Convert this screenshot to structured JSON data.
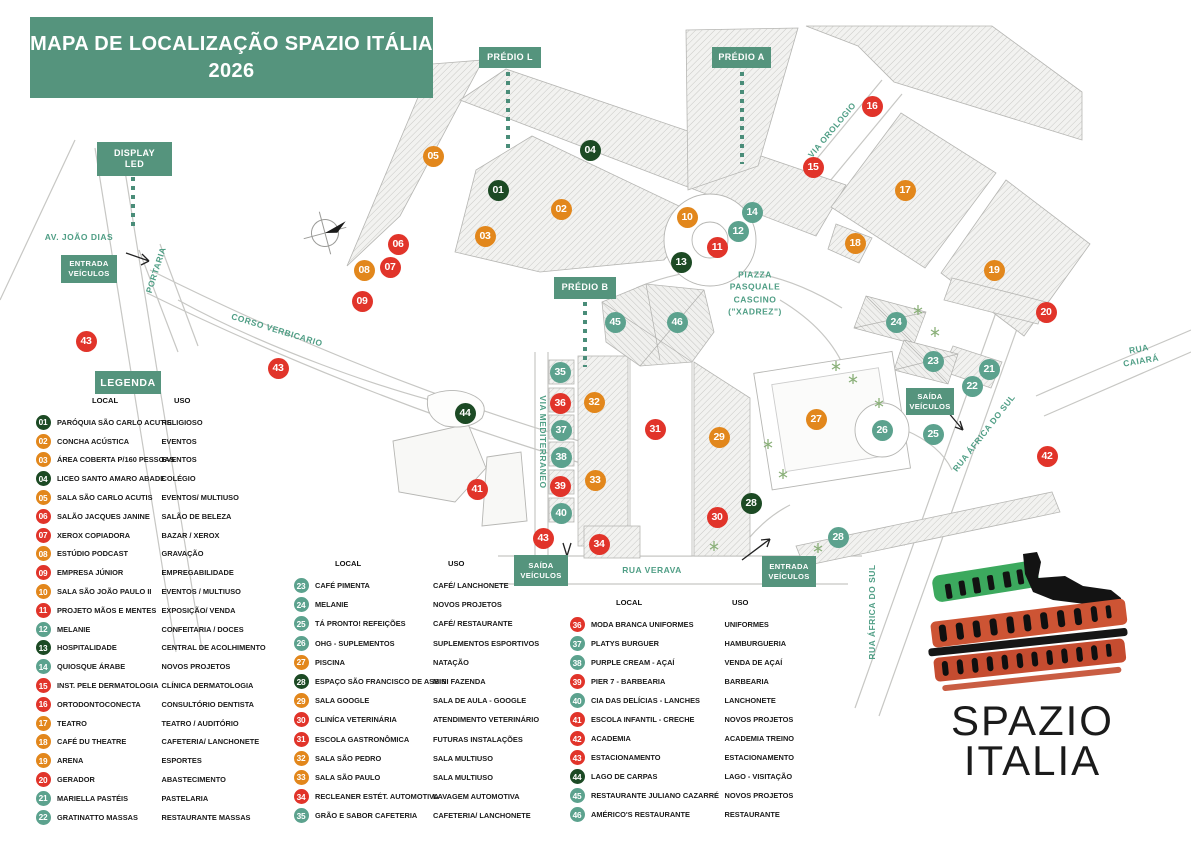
{
  "title": {
    "line1": "MAPA DE LOCALIZAÇÃO SPAZIO ITÁLIA",
    "line2": "2026"
  },
  "colors": {
    "green": "#1C4A24",
    "orange": "#E2871C",
    "red": "#E1342A",
    "teal": "#5CA28E",
    "box_teal": "#55947D",
    "street_text": "#4F9E85"
  },
  "map_labels": [
    {
      "id": "predio-l",
      "t": "PRÉDIO L",
      "x": 479,
      "y": 47,
      "w": 62,
      "h": 21
    },
    {
      "id": "predio-a",
      "t": "PRÉDIO A",
      "x": 712,
      "y": 47,
      "w": 59,
      "h": 21
    },
    {
      "id": "predio-b",
      "t": "PRÉDIO B",
      "x": 554,
      "y": 277,
      "w": 62,
      "h": 22
    },
    {
      "id": "display-led",
      "t": "DISPLAY\nLED",
      "x": 97,
      "y": 142,
      "w": 75,
      "h": 34
    }
  ],
  "gates": [
    {
      "id": "entrada-veiculos-oeste",
      "t": "ENTRADA\nVEÍCULOS",
      "x": 61,
      "y": 255,
      "w": 56,
      "h": 28
    },
    {
      "id": "saida-veiculos-leste",
      "t": "SAÍDA\nVEÍCULOS",
      "x": 906,
      "y": 388,
      "w": 48,
      "h": 27
    },
    {
      "id": "saida-veiculos-sul",
      "t": "SAÍDA\nVEÍCULOS",
      "x": 514,
      "y": 555,
      "w": 54,
      "h": 31
    },
    {
      "id": "entrada-veiculos-sul",
      "t": "ENTRADA\nVEÍCULOS",
      "x": 762,
      "y": 556,
      "w": 54,
      "h": 31
    }
  ],
  "streets": [
    {
      "t": "AV. JOÃO DIAS",
      "x": 79,
      "y": 237,
      "r": 0
    },
    {
      "t": "PORTARIA",
      "x": 156,
      "y": 270,
      "r": -72
    },
    {
      "t": "CORSO VERBICARIO",
      "x": 277,
      "y": 330,
      "r": 17
    },
    {
      "t": "VIA OROLOGIO",
      "x": 832,
      "y": 130,
      "r": -50
    },
    {
      "t": "VIA MEDITERRANEO",
      "x": 543,
      "y": 442,
      "r": 90
    },
    {
      "t": "RUA VERAVA",
      "x": 652,
      "y": 570,
      "r": 0
    },
    {
      "t": "RUA CAIARÁ",
      "x": 1140,
      "y": 355,
      "r": -10
    },
    {
      "t": "RUA ÁFRICA DO SUL",
      "x": 984,
      "y": 433,
      "r": -52
    },
    {
      "t": "RUA ÁFRICA DO SUL",
      "x": 872,
      "y": 612,
      "r": -90
    },
    {
      "t": "PIAZZA\nPASQUALE\nCASCINO\n(\"XADREZ\")",
      "x": 755,
      "y": 293,
      "r": 0
    }
  ],
  "markers": [
    {
      "n": "01",
      "c": "green",
      "x": 498,
      "y": 190
    },
    {
      "n": "02",
      "c": "orange",
      "x": 561,
      "y": 209
    },
    {
      "n": "03",
      "c": "orange",
      "x": 485,
      "y": 236
    },
    {
      "n": "04",
      "c": "green",
      "x": 590,
      "y": 150
    },
    {
      "n": "05",
      "c": "orange",
      "x": 433,
      "y": 156
    },
    {
      "n": "06",
      "c": "red",
      "x": 398,
      "y": 244
    },
    {
      "n": "07",
      "c": "red",
      "x": 390,
      "y": 267
    },
    {
      "n": "08",
      "c": "orange",
      "x": 364,
      "y": 270
    },
    {
      "n": "09",
      "c": "red",
      "x": 362,
      "y": 301
    },
    {
      "n": "10",
      "c": "orange",
      "x": 687,
      "y": 217
    },
    {
      "n": "11",
      "c": "red",
      "x": 717,
      "y": 247
    },
    {
      "n": "12",
      "c": "teal",
      "x": 738,
      "y": 231
    },
    {
      "n": "13",
      "c": "green",
      "x": 681,
      "y": 262
    },
    {
      "n": "14",
      "c": "teal",
      "x": 752,
      "y": 212
    },
    {
      "n": "15",
      "c": "red",
      "x": 813,
      "y": 167
    },
    {
      "n": "16",
      "c": "red",
      "x": 872,
      "y": 106
    },
    {
      "n": "17",
      "c": "orange",
      "x": 905,
      "y": 190
    },
    {
      "n": "18",
      "c": "orange",
      "x": 855,
      "y": 243
    },
    {
      "n": "19",
      "c": "orange",
      "x": 994,
      "y": 270
    },
    {
      "n": "20",
      "c": "red",
      "x": 1046,
      "y": 312
    },
    {
      "n": "21",
      "c": "teal",
      "x": 989,
      "y": 369
    },
    {
      "n": "22",
      "c": "teal",
      "x": 972,
      "y": 386
    },
    {
      "n": "23",
      "c": "teal",
      "x": 933,
      "y": 361
    },
    {
      "n": "24",
      "c": "teal",
      "x": 896,
      "y": 322
    },
    {
      "n": "25",
      "c": "teal",
      "x": 933,
      "y": 434
    },
    {
      "n": "26",
      "c": "teal",
      "x": 882,
      "y": 430
    },
    {
      "n": "27",
      "c": "orange",
      "x": 816,
      "y": 419
    },
    {
      "n": "28",
      "c": "green",
      "x": 751,
      "y": 503
    },
    {
      "n": "28",
      "c": "teal",
      "x": 838,
      "y": 537
    },
    {
      "n": "29",
      "c": "orange",
      "x": 719,
      "y": 437
    },
    {
      "n": "30",
      "c": "red",
      "x": 717,
      "y": 517
    },
    {
      "n": "31",
      "c": "red",
      "x": 655,
      "y": 429
    },
    {
      "n": "32",
      "c": "orange",
      "x": 594,
      "y": 402
    },
    {
      "n": "33",
      "c": "orange",
      "x": 595,
      "y": 480
    },
    {
      "n": "34",
      "c": "red",
      "x": 599,
      "y": 544
    },
    {
      "n": "35",
      "c": "teal",
      "x": 560,
      "y": 372
    },
    {
      "n": "36",
      "c": "red",
      "x": 560,
      "y": 403
    },
    {
      "n": "37",
      "c": "teal",
      "x": 561,
      "y": 430
    },
    {
      "n": "38",
      "c": "teal",
      "x": 561,
      "y": 457
    },
    {
      "n": "39",
      "c": "red",
      "x": 560,
      "y": 486
    },
    {
      "n": "40",
      "c": "teal",
      "x": 561,
      "y": 513
    },
    {
      "n": "41",
      "c": "red",
      "x": 477,
      "y": 489
    },
    {
      "n": "42",
      "c": "red",
      "x": 1047,
      "y": 456
    },
    {
      "n": "43",
      "c": "red",
      "x": 86,
      "y": 341
    },
    {
      "n": "43",
      "c": "red",
      "x": 278,
      "y": 368
    },
    {
      "n": "43",
      "c": "red",
      "x": 543,
      "y": 538
    },
    {
      "n": "44",
      "c": "green",
      "x": 465,
      "y": 413
    },
    {
      "n": "45",
      "c": "teal",
      "x": 615,
      "y": 322
    },
    {
      "n": "46",
      "c": "teal",
      "x": 677,
      "y": 322
    }
  ],
  "legend": {
    "header": "LEGENDA",
    "col_local": "LOCAL",
    "col_uso": "USO",
    "columns": [
      {
        "x": 33,
        "y": 392,
        "row_h": 18.8,
        "lw": 104.5,
        "hx": 59,
        "ux": 141,
        "items": [
          {
            "n": "01",
            "c": "green",
            "local": "PARÓQUIA SÃO CARLO ACUTIS",
            "uso": "RELIGIOSO"
          },
          {
            "n": "02",
            "c": "orange",
            "local": "CONCHA ACÚSTICA",
            "uso": "EVENTOS"
          },
          {
            "n": "03",
            "c": "orange",
            "local": "ÁREA COBERTA P/160 PESSOAS",
            "uso": "EVENTOS"
          },
          {
            "n": "04",
            "c": "green",
            "local": "LICEO SANTO AMARO ABADE",
            "uso": "COLÉGIO"
          },
          {
            "n": "05",
            "c": "orange",
            "local": "SALA SÃO CARLO ACUTIS",
            "uso": "EVENTOS/ MULTIUSO"
          },
          {
            "n": "06",
            "c": "red",
            "local": "SALÃO JACQUES JANINE",
            "uso": "SALÃO DE BELEZA"
          },
          {
            "n": "07",
            "c": "red",
            "local": "XEROX COPIADORA",
            "uso": "BAZAR / XEROX"
          },
          {
            "n": "08",
            "c": "orange",
            "local": "ESTÚDIO PODCAST",
            "uso": "GRAVAÇÃO"
          },
          {
            "n": "09",
            "c": "red",
            "local": "EMPRESA JÚNIOR",
            "uso": "EMPREGABILIDADE"
          },
          {
            "n": "10",
            "c": "orange",
            "local": "SALA SÃO JOÃO PAULO II",
            "uso": "EVENTOS / MULTIUSO"
          },
          {
            "n": "11",
            "c": "red",
            "local": "PROJETO MÃOS E MENTES",
            "uso": "EXPOSIÇÃO/ VENDA"
          },
          {
            "n": "12",
            "c": "teal",
            "local": "MELANIE",
            "uso": "CONFEITARIA / DOCES"
          },
          {
            "n": "13",
            "c": "green",
            "local": "HOSPITALIDADE",
            "uso": "CENTRAL DE ACOLHIMENTO"
          },
          {
            "n": "14",
            "c": "teal",
            "local": "QUIOSQUE ÁRABE",
            "uso": "NOVOS PROJETOS"
          },
          {
            "n": "15",
            "c": "red",
            "local": "INST. PELE DERMATOLOGIA",
            "uso": "CLÍNICA DERMATOLOGIA"
          },
          {
            "n": "16",
            "c": "red",
            "local": "ORTODONTOCONECTA",
            "uso": "CONSULTÓRIO DENTISTA"
          },
          {
            "n": "17",
            "c": "orange",
            "local": "TEATRO",
            "uso": "TEATRO / AUDITÓRIO"
          },
          {
            "n": "18",
            "c": "orange",
            "local": "CAFÉ DU THEATRE",
            "uso": "CAFETERIA/ LANCHONETE"
          },
          {
            "n": "19",
            "c": "orange",
            "local": "ARENA",
            "uso": "ESPORTES"
          },
          {
            "n": "20",
            "c": "red",
            "local": "GERADOR",
            "uso": "ABASTECIMENTO"
          },
          {
            "n": "21",
            "c": "teal",
            "local": "MARIELLA PASTÉIS",
            "uso": "PASTELARIA"
          },
          {
            "n": "22",
            "c": "teal",
            "local": "GRATINATTO MASSAS",
            "uso": "RESTAURANTE MASSAS"
          }
        ]
      },
      {
        "x": 291,
        "y": 555,
        "row_h": 19.2,
        "lw": 118,
        "hx": 44,
        "ux": 157,
        "items": [
          {
            "n": "23",
            "c": "teal",
            "local": "CAFÉ PIMENTA",
            "uso": "CAFÉ/ LANCHONETE"
          },
          {
            "n": "24",
            "c": "teal",
            "local": "MELANIE",
            "uso": "NOVOS PROJETOS"
          },
          {
            "n": "25",
            "c": "teal",
            "local": "TÁ PRONTO! REFEIÇÕES",
            "uso": "CAFÉ/ RESTAURANTE"
          },
          {
            "n": "26",
            "c": "teal",
            "local": "OHG - SUPLEMENTOS",
            "uso": "SUPLEMENTOS ESPORTIVOS"
          },
          {
            "n": "27",
            "c": "orange",
            "local": "PISCINA",
            "uso": "NATAÇÃO"
          },
          {
            "n": "28",
            "c": "green",
            "local": "ESPAÇO SÃO FRANCISCO DE ASSIS",
            "uso": "MINI FAZENDA"
          },
          {
            "n": "29",
            "c": "orange",
            "local": "SALA GOOGLE",
            "uso": "SALA DE AULA - GOOGLE"
          },
          {
            "n": "30",
            "c": "red",
            "local": "CLINÍCA VETERINÁRIA",
            "uso": "ATENDIMENTO VETERINÁRIO"
          },
          {
            "n": "31",
            "c": "red",
            "local": "ESCOLA GASTRONÔMICA",
            "uso": "FUTURAS INSTALAÇÕES"
          },
          {
            "n": "32",
            "c": "orange",
            "local": "SALA SÃO PEDRO",
            "uso": "SALA MULTIUSO"
          },
          {
            "n": "33",
            "c": "orange",
            "local": "SALA SÃO PAULO",
            "uso": "SALA MULTIUSO"
          },
          {
            "n": "34",
            "c": "red",
            "local": "RECLEANER ESTÉT. AUTOMOTIVA",
            "uso": "LAVAGEM AUTOMOTIVA"
          },
          {
            "n": "35",
            "c": "teal",
            "local": "GRÃO E SABOR CAFETERIA",
            "uso": "CAFETERIA/ LANCHONETE"
          }
        ]
      },
      {
        "x": 567,
        "y": 594,
        "row_h": 19,
        "lw": 133.5,
        "hx": 49,
        "ux": 165,
        "items": [
          {
            "n": "36",
            "c": "red",
            "local": "MODA BRANCA UNIFORMES",
            "uso": "UNIFORMES"
          },
          {
            "n": "37",
            "c": "teal",
            "local": "PLATYS BURGUER",
            "uso": "HAMBURGUERIA"
          },
          {
            "n": "38",
            "c": "teal",
            "local": "PURPLE CREAM - AÇAÍ",
            "uso": "VENDA DE AÇAÍ"
          },
          {
            "n": "39",
            "c": "red",
            "local": "PIER 7 - BARBEARIA",
            "uso": "BARBEARIA"
          },
          {
            "n": "40",
            "c": "teal",
            "local": "CIA DAS DELÍCIAS - LANCHES",
            "uso": "LANCHONETE"
          },
          {
            "n": "41",
            "c": "red",
            "local": "ESCOLA INFANTIL - CRECHE",
            "uso": "NOVOS PROJETOS"
          },
          {
            "n": "42",
            "c": "red",
            "local": "ACADEMIA",
            "uso": "ACADEMIA TREINO"
          },
          {
            "n": "43",
            "c": "red",
            "local": "ESTACIONAMENTO",
            "uso": "ESTACIONAMENTO"
          },
          {
            "n": "44",
            "c": "green",
            "local": "LAGO DE CARPAS",
            "uso": "LAGO - VISITAÇÃO"
          },
          {
            "n": "45",
            "c": "teal",
            "local": "RESTAURANTE JULIANO CAZARRÉ",
            "uso": "NOVOS PROJETOS"
          },
          {
            "n": "46",
            "c": "teal",
            "local": "AMÉRICO'S RESTAURANTE",
            "uso": "RESTAURANTE"
          }
        ]
      }
    ]
  },
  "logo": {
    "line1": "SPAZIO",
    "line2": "ITALIA"
  }
}
